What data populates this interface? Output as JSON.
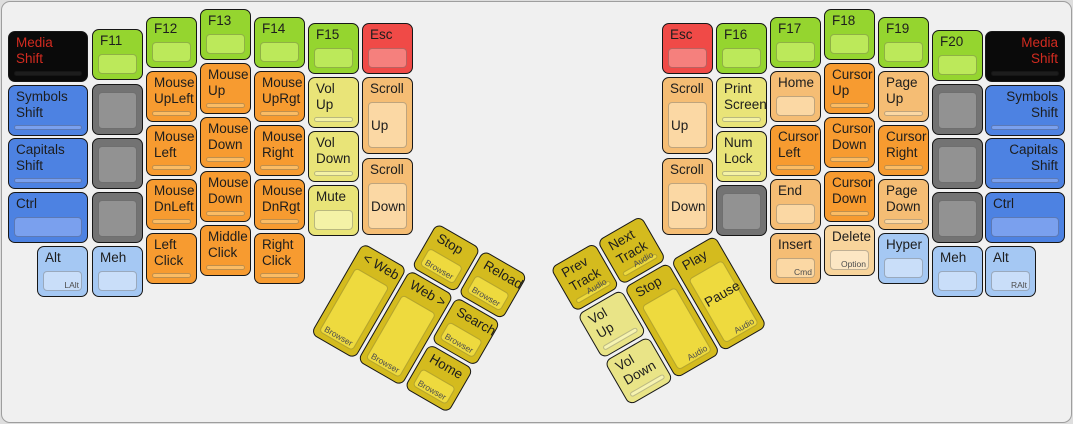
{
  "app": {
    "title": "ErgoDox keyboard layout — media / mouse / function layer"
  },
  "colors": {
    "black": {
      "outer": "#0a0a0a",
      "inner": "#1d1d1d",
      "text": "#d22b20"
    },
    "blue": {
      "outer": "#4d82e2",
      "inner": "#7aa0ee"
    },
    "lightblue": {
      "outer": "#a5c8f3",
      "inner": "#c9def9"
    },
    "gray": {
      "outer": "#737373",
      "inner": "#929292"
    },
    "green": {
      "outer": "#95d52f",
      "inner": "#bce95a"
    },
    "red": {
      "outer": "#f04a47",
      "inner": "#f5807d"
    },
    "orange": {
      "outer": "#f79b30",
      "inner": "#fbbc64"
    },
    "peach": {
      "outer": "#f5bd74",
      "inner": "#fbd8a4"
    },
    "peachlight": {
      "outer": "#f8d49b",
      "inner": "#fce6c3"
    },
    "yellow": {
      "outer": "#e9e478",
      "inner": "#f4f2a6"
    },
    "gold": {
      "outer": "#d4bb1e",
      "inner": "#eeda3e"
    },
    "goldlight": {
      "outer": "#e9e487",
      "inner": "#f6f3b0"
    }
  },
  "keyboard": {
    "left_main": [
      {
        "id": "media-shift-left",
        "color": "black",
        "x": 8,
        "y": 31,
        "w": 80,
        "label": [
          "Media",
          "Shift"
        ]
      },
      {
        "id": "symbols-shift-left",
        "color": "blue",
        "x": 8,
        "y": 85,
        "w": 80,
        "label": [
          "Symbols",
          "Shift"
        ]
      },
      {
        "id": "capitals-shift-left",
        "color": "blue",
        "x": 8,
        "y": 138,
        "w": 80,
        "label": [
          "Capitals",
          "Shift"
        ]
      },
      {
        "id": "ctrl-left",
        "color": "blue",
        "x": 8,
        "y": 192,
        "w": 80,
        "label": [
          "Ctrl"
        ]
      },
      {
        "id": "alt-left",
        "color": "lightblue",
        "x": 37,
        "y": 246,
        "label": [
          "Alt"
        ],
        "sub": "LAlt"
      },
      {
        "id": "f11",
        "color": "green",
        "x": 92,
        "y": 29,
        "label": [
          "F11"
        ]
      },
      {
        "id": "blank-left-1",
        "color": "gray",
        "x": 92,
        "y": 84
      },
      {
        "id": "blank-left-2",
        "color": "gray",
        "x": 92,
        "y": 138
      },
      {
        "id": "blank-left-3",
        "color": "gray",
        "x": 92,
        "y": 192
      },
      {
        "id": "meh-left",
        "color": "lightblue",
        "x": 92,
        "y": 246,
        "label": [
          "Meh"
        ]
      },
      {
        "id": "f12",
        "color": "green",
        "x": 146,
        "y": 17,
        "label": [
          "F12"
        ]
      },
      {
        "id": "mouse-upleft",
        "color": "orange",
        "x": 146,
        "y": 71,
        "label": [
          "Mouse",
          "UpLeft"
        ]
      },
      {
        "id": "mouse-left",
        "color": "orange",
        "x": 146,
        "y": 125,
        "label": [
          "Mouse",
          "Left"
        ]
      },
      {
        "id": "mouse-dnleft",
        "color": "orange",
        "x": 146,
        "y": 179,
        "label": [
          "Mouse",
          "DnLeft"
        ]
      },
      {
        "id": "left-click",
        "color": "orange",
        "x": 146,
        "y": 233,
        "label": [
          "Left",
          "Click"
        ]
      },
      {
        "id": "f13",
        "color": "green",
        "x": 200,
        "y": 9,
        "label": [
          "F13"
        ]
      },
      {
        "id": "mouse-up",
        "color": "orange",
        "x": 200,
        "y": 63,
        "label": [
          "Mouse",
          "Up"
        ]
      },
      {
        "id": "mouse-down-1",
        "color": "orange",
        "x": 200,
        "y": 117,
        "label": [
          "Mouse",
          "Down"
        ]
      },
      {
        "id": "mouse-down-2",
        "color": "orange",
        "x": 200,
        "y": 171,
        "label": [
          "Mouse",
          "Down"
        ]
      },
      {
        "id": "middle-click",
        "color": "orange",
        "x": 200,
        "y": 225,
        "label": [
          "Middle",
          "Click"
        ]
      },
      {
        "id": "f14",
        "color": "green",
        "x": 254,
        "y": 17,
        "label": [
          "F14"
        ]
      },
      {
        "id": "mouse-uprgt",
        "color": "orange",
        "x": 254,
        "y": 71,
        "label": [
          "Mouse",
          "UpRgt"
        ]
      },
      {
        "id": "mouse-right",
        "color": "orange",
        "x": 254,
        "y": 125,
        "label": [
          "Mouse",
          "Right"
        ]
      },
      {
        "id": "mouse-dnrgt",
        "color": "orange",
        "x": 254,
        "y": 179,
        "label": [
          "Mouse",
          "DnRgt"
        ]
      },
      {
        "id": "right-click",
        "color": "orange",
        "x": 254,
        "y": 233,
        "label": [
          "Right",
          "Click"
        ]
      },
      {
        "id": "f15",
        "color": "green",
        "x": 308,
        "y": 23,
        "label": [
          "F15"
        ]
      },
      {
        "id": "vol-up-left",
        "color": "yellow",
        "x": 308,
        "y": 77,
        "label": [
          "Vol",
          "Up"
        ]
      },
      {
        "id": "vol-down-left",
        "color": "yellow",
        "x": 308,
        "y": 131,
        "label": [
          "Vol",
          "Down"
        ]
      },
      {
        "id": "mute",
        "color": "yellow",
        "x": 308,
        "y": 185,
        "label": [
          "Mute"
        ]
      },
      {
        "id": "esc-left",
        "color": "red",
        "x": 362,
        "y": 23,
        "label": [
          "Esc"
        ]
      },
      {
        "id": "scroll-up-left",
        "color": "peach",
        "x": 362,
        "y": 77,
        "h": 77,
        "label": [
          "Scroll"
        ],
        "l2": "Up",
        "l2y": 40
      },
      {
        "id": "scroll-down-left",
        "color": "peach",
        "x": 362,
        "y": 158,
        "h": 77,
        "label": [
          "Scroll"
        ],
        "l2": "Down",
        "l2y": 40
      }
    ],
    "right_main": [
      {
        "id": "esc-right",
        "color": "red",
        "x": 662,
        "y": 23,
        "label": [
          "Esc"
        ]
      },
      {
        "id": "scroll-up-right",
        "color": "peach",
        "x": 662,
        "y": 77,
        "h": 77,
        "label": [
          "Scroll"
        ],
        "l2": "Up",
        "l2y": 40
      },
      {
        "id": "scroll-down-right",
        "color": "peach",
        "x": 662,
        "y": 158,
        "h": 77,
        "label": [
          "Scroll"
        ],
        "l2": "Down",
        "l2y": 40
      },
      {
        "id": "f16",
        "color": "green",
        "x": 716,
        "y": 23,
        "label": [
          "F16"
        ]
      },
      {
        "id": "print-screen",
        "color": "yellow",
        "x": 716,
        "y": 77,
        "label": [
          "Print",
          "Screen"
        ]
      },
      {
        "id": "num-lock",
        "color": "yellow",
        "x": 716,
        "y": 131,
        "label": [
          "Num",
          "Lock"
        ]
      },
      {
        "id": "blank-right-1",
        "color": "gray",
        "x": 716,
        "y": 185
      },
      {
        "id": "f17",
        "color": "green",
        "x": 770,
        "y": 17,
        "label": [
          "F17"
        ]
      },
      {
        "id": "home",
        "color": "peach",
        "x": 770,
        "y": 71,
        "label": [
          "Home"
        ]
      },
      {
        "id": "cursor-left",
        "color": "orange",
        "x": 770,
        "y": 125,
        "label": [
          "Cursor",
          "Left"
        ]
      },
      {
        "id": "end",
        "color": "peach",
        "x": 770,
        "y": 179,
        "label": [
          "End"
        ]
      },
      {
        "id": "insert",
        "color": "peach",
        "x": 770,
        "y": 233,
        "label": [
          "Insert"
        ],
        "sub": "Cmd"
      },
      {
        "id": "f18",
        "color": "green",
        "x": 824,
        "y": 9,
        "label": [
          "F18"
        ]
      },
      {
        "id": "cursor-up",
        "color": "orange",
        "x": 824,
        "y": 63,
        "label": [
          "Cursor",
          "Up"
        ]
      },
      {
        "id": "cursor-down-1",
        "color": "orange",
        "x": 824,
        "y": 117,
        "label": [
          "Cursor",
          "Down"
        ]
      },
      {
        "id": "cursor-down-2",
        "color": "orange",
        "x": 824,
        "y": 171,
        "label": [
          "Cursor",
          "Down"
        ]
      },
      {
        "id": "delete",
        "color": "peachlight",
        "x": 824,
        "y": 225,
        "label": [
          "Delete"
        ],
        "sub": "Option"
      },
      {
        "id": "f19",
        "color": "green",
        "x": 878,
        "y": 17,
        "label": [
          "F19"
        ]
      },
      {
        "id": "page-up",
        "color": "peach",
        "x": 878,
        "y": 71,
        "label": [
          "Page",
          "Up"
        ]
      },
      {
        "id": "cursor-right",
        "color": "orange",
        "x": 878,
        "y": 125,
        "label": [
          "Cursor",
          "Right"
        ]
      },
      {
        "id": "page-down",
        "color": "peach",
        "x": 878,
        "y": 179,
        "label": [
          "Page",
          "Down"
        ]
      },
      {
        "id": "hyper",
        "color": "lightblue",
        "x": 878,
        "y": 233,
        "label": [
          "Hyper"
        ]
      },
      {
        "id": "f20",
        "color": "green",
        "x": 932,
        "y": 30,
        "label": [
          "F20"
        ]
      },
      {
        "id": "blank-right-2",
        "color": "gray",
        "x": 932,
        "y": 84
      },
      {
        "id": "blank-right-3",
        "color": "gray",
        "x": 932,
        "y": 138
      },
      {
        "id": "blank-right-4",
        "color": "gray",
        "x": 932,
        "y": 192
      },
      {
        "id": "meh-right",
        "color": "lightblue",
        "x": 932,
        "y": 246,
        "label": [
          "Meh"
        ]
      },
      {
        "id": "media-shift-right",
        "color": "black",
        "x": 985,
        "y": 31,
        "w": 80,
        "label": [
          "Media",
          "Shift"
        ],
        "align": "right"
      },
      {
        "id": "symbols-shift-right",
        "color": "blue",
        "x": 985,
        "y": 85,
        "w": 80,
        "label": [
          "Symbols",
          "Shift"
        ],
        "align": "right"
      },
      {
        "id": "capitals-shift-right",
        "color": "blue",
        "x": 985,
        "y": 138,
        "w": 80,
        "label": [
          "Capitals",
          "Shift"
        ],
        "align": "right"
      },
      {
        "id": "ctrl-right",
        "color": "blue",
        "x": 985,
        "y": 192,
        "w": 80,
        "label": [
          "Ctrl"
        ]
      },
      {
        "id": "alt-right",
        "color": "lightblue",
        "x": 985,
        "y": 246,
        "label": [
          "Alt"
        ],
        "sub": "RAlt"
      }
    ],
    "left_thumb": {
      "x": 390,
      "y": 196,
      "angle": 30,
      "keys": [
        {
          "id": "browser-stop",
          "color": "gold",
          "x": 54,
          "y": 0,
          "label": [
            "Stop"
          ],
          "sub": "Browser",
          "subpos": "center"
        },
        {
          "id": "browser-reload",
          "color": "gold",
          "x": 108,
          "y": 0,
          "label": [
            "Reload"
          ],
          "sub": "Browser",
          "subpos": "center"
        },
        {
          "id": "web-back",
          "color": "gold",
          "x": 0,
          "y": 54,
          "h": 105,
          "label": [
            "< Web"
          ],
          "sub": "Browser",
          "subpos": "center"
        },
        {
          "id": "web-forward",
          "color": "gold",
          "x": 54,
          "y": 54,
          "h": 105,
          "label": [
            "Web >"
          ],
          "sub": "Browser",
          "subpos": "center"
        },
        {
          "id": "browser-search",
          "color": "gold",
          "x": 108,
          "y": 54,
          "label": [
            "Search"
          ],
          "sub": "Browser",
          "subpos": "center"
        },
        {
          "id": "browser-home",
          "color": "gold",
          "x": 108,
          "y": 108,
          "label": [
            "Home"
          ],
          "sub": "Browser",
          "subpos": "center"
        }
      ]
    },
    "right_thumb": {
      "x": 550,
      "y": 268,
      "angle": -30,
      "keys": [
        {
          "id": "prev-track",
          "color": "gold",
          "x": 0,
          "y": 0,
          "label": [
            "Prev",
            "Track"
          ],
          "sub": "Audio"
        },
        {
          "id": "next-track",
          "color": "gold",
          "x": 54,
          "y": 0,
          "label": [
            "Next",
            "Track"
          ],
          "sub": "Audio"
        },
        {
          "id": "vol-up-right",
          "color": "goldlight",
          "x": 0,
          "y": 54,
          "label": [
            "Vol",
            "Up"
          ]
        },
        {
          "id": "audio-stop",
          "color": "gold",
          "x": 54,
          "y": 54,
          "h": 105,
          "label": [
            "Stop"
          ],
          "sub": "Audio"
        },
        {
          "id": "play-pause",
          "color": "gold",
          "x": 108,
          "y": 54,
          "h": 105,
          "label": [
            "Play"
          ],
          "l2": "Pause",
          "l2y": 46,
          "sub": "Audio"
        },
        {
          "id": "vol-down-right",
          "color": "goldlight",
          "x": 0,
          "y": 108,
          "label": [
            "Vol",
            "Down"
          ]
        }
      ]
    }
  }
}
